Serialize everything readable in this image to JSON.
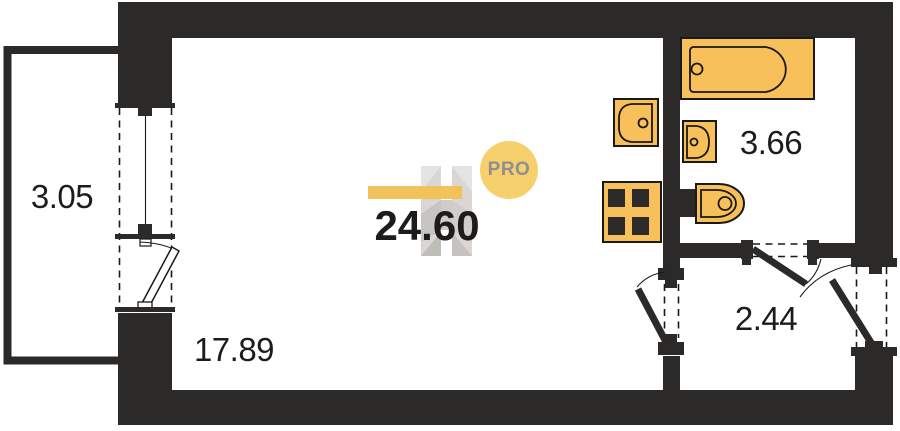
{
  "plan": {
    "total_area_label": "24.60",
    "watermark": {
      "badge_label": "PRO"
    },
    "rooms": [
      {
        "name": "balcony",
        "area_label": "3.05"
      },
      {
        "name": "living-room-kitchen",
        "area_label": "17.89"
      },
      {
        "name": "bathroom",
        "area_label": "3.66"
      },
      {
        "name": "hallway",
        "area_label": "2.44"
      }
    ],
    "fixtures": [
      {
        "name": "bathtub"
      },
      {
        "name": "kitchen-sink"
      },
      {
        "name": "bathroom-sink"
      },
      {
        "name": "toilet"
      },
      {
        "name": "stove"
      },
      {
        "name": "window"
      },
      {
        "name": "balcony-door"
      },
      {
        "name": "room-door"
      },
      {
        "name": "bathroom-door"
      },
      {
        "name": "entrance-door"
      }
    ],
    "colors": {
      "wall": "#2b2a28",
      "line": "#1a1918",
      "fixture": "#f7c05a",
      "text": "#1d1c1b",
      "accent_bar": "#f2c155",
      "badge_fill": "#f6d06d",
      "badge_text": "#8f8f8f",
      "watermark": "#d5d2cf"
    }
  }
}
